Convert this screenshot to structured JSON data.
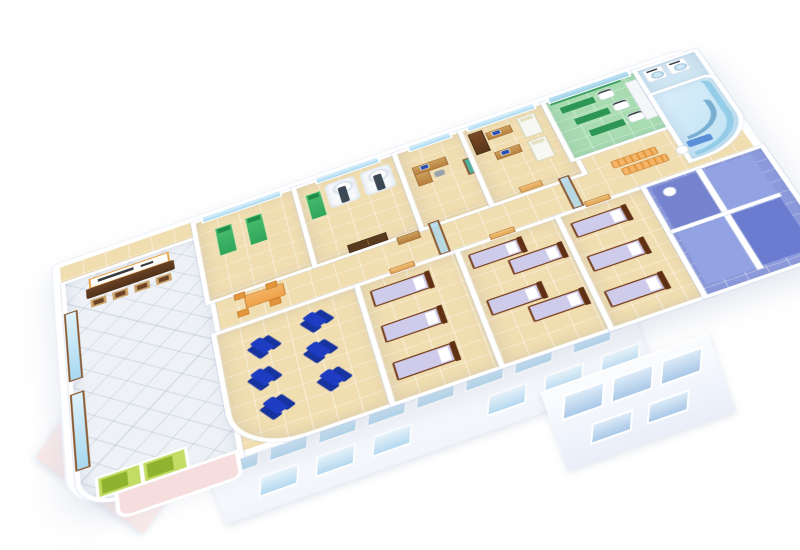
{
  "scene": {
    "type": "3d-isometric-cutaway-floor-plan",
    "subject": "hospital / clinic floor rendered in bird's-eye isometric view on a plain white background",
    "orientation": "building long axis rises from lower-left to upper-right; near-side facade with windows visible at bottom",
    "background": "#ffffff",
    "visible_text": "none legible (only an illegible dark-lettered signboard above the reception counter)"
  },
  "palette": {
    "wall": "#ffffff",
    "floor_tile": "#f0ddb0",
    "lobby_tile": "#eef2f6",
    "window_glass": "#a9d9f0",
    "window_frame_brown": "#8a5a33",
    "facade_glass": "#b5d9ef",
    "facade_left_pink": "#f9e9e9",
    "door_wood": "#e0a352",
    "door_dark": "#5a3a1e",
    "counter_brown": "#4f3219",
    "sign_frame": "#e8a23c",
    "bed_green": "#2fa65a",
    "bed_lavender": "#cfcbea",
    "bed_frame": "#7a4424",
    "recliner_blue": "#1d3cc2",
    "bench_orange": "#efa24a",
    "or_floor": "#a8dcb0",
    "or_green": "#3fa163",
    "scanner_white": "#f7f9fb",
    "scanner_table": "#3c4754",
    "bath_floor": "#8e9cdd",
    "laundry_floor": "#cfe6f2",
    "spa_glass": "#bfe2f4",
    "elevator_green": "#c3dc64",
    "porch_pink": "#f6dede"
  },
  "rooms": [
    {
      "id": "entrance-lobby",
      "floor": "white diagonal tiles",
      "items": [
        "dark-brown reception counter",
        "white signboard with orange frame and illegible dark lettering",
        "4 visitor chairs",
        "brown-framed window wall on left",
        "2 green elevator doors",
        "pink entrance porch"
      ]
    },
    {
      "id": "exam-room",
      "floor": "tan tiles",
      "items": [
        "2 green examination beds",
        "window"
      ]
    },
    {
      "id": "imaging-room",
      "floor": "tan tiles",
      "items": [
        "2 white scanner machines with dark patient tables",
        "1 green examination bed",
        "dark-brown double door to corridor"
      ]
    },
    {
      "id": "doctor-office",
      "floor": "tan tiles",
      "items": [
        "L-shaped desk",
        "computer",
        "chair",
        "teal mirror panel"
      ]
    },
    {
      "id": "consultation-room",
      "floor": "tan tiles",
      "items": [
        "tall brown cabinet",
        "2 desks with computers",
        "2 white exam couches"
      ]
    },
    {
      "id": "operating-room",
      "floor": "green tiles",
      "items": [
        "3 green operating tables",
        "3 white surgical machines",
        "green wall panel",
        "white equipment cabinet"
      ]
    },
    {
      "id": "laundry-room",
      "floor": "light blue",
      "items": [
        "2 white front-loading machines"
      ]
    },
    {
      "id": "spa-corner",
      "floor": "light blue",
      "items": [
        "curved glass outer wall",
        "curved bench",
        "small blue couch"
      ]
    },
    {
      "id": "corridor",
      "floor": "tan tiles",
      "items": [
        "orange dining table with 4 chairs",
        "2 orange waiting benches",
        "2 glass partition doors",
        "small brown desk",
        "wooden room doors",
        "WC with toilet"
      ]
    },
    {
      "id": "infusion-lounge",
      "floor": "tan tiles",
      "items": [
        "6 royal-blue recliner chairs",
        "rounded outer corner"
      ]
    },
    {
      "id": "ward-1",
      "floor": "tan tiles",
      "items": [
        "3 beds with lavender bedding and wooden frames",
        "wooden door"
      ]
    },
    {
      "id": "ward-2",
      "floor": "tan tiles",
      "items": [
        "4 beds with lavender bedding and wooden frames",
        "wooden door"
      ]
    },
    {
      "id": "ward-3",
      "floor": "tan tiles",
      "items": [
        "3 beds with lavender bedding and wooden frames",
        "wooden door"
      ]
    },
    {
      "id": "bathroom-suite",
      "floor": "blue/violet tiles",
      "items": [
        "4 shower-toilet stalls",
        "white partition walls",
        "toilet"
      ]
    }
  ],
  "counts": {
    "recliner_chairs": 6,
    "ward_beds": 10,
    "green_exam_beds": 3,
    "scanners": 2,
    "operating_tables": 3,
    "surgical_machines": 3,
    "washing_machines": 2,
    "white_exam_couches": 2,
    "desks": 4,
    "computers": 3,
    "waiting_benches": 2,
    "visitor_chairs": 4,
    "elevators": 2,
    "shower_stalls": 4,
    "facade_windows_long_side": 14,
    "facade_windows_right_end": 5,
    "facade_windows_left_end": 2
  }
}
